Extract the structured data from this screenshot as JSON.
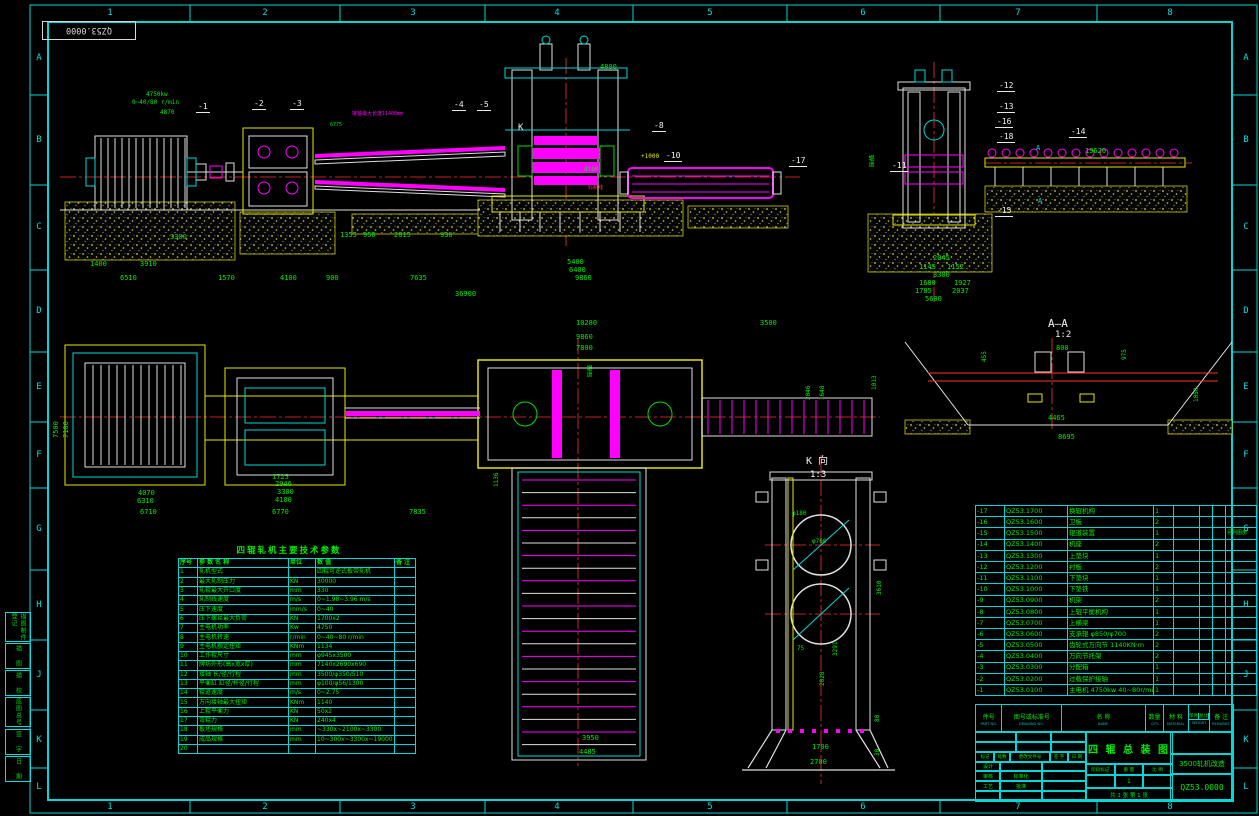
{
  "frame": {
    "corner_label": "QZ53.0000",
    "column_labels": [
      "1",
      "2",
      "3",
      "4",
      "5",
      "6",
      "7",
      "8"
    ],
    "row_labels": [
      "A",
      "B",
      "C",
      "D",
      "E",
      "F",
      "G",
      "H",
      "J",
      "K",
      "L"
    ]
  },
  "margin_notes": [
    "描图制件登记",
    "描 图",
    "描 校",
    "底图总号",
    "签 字",
    "日 期"
  ],
  "callouts": [
    {
      "t": "-1",
      "x": 196,
      "y": 103
    },
    {
      "t": "-2",
      "x": 252,
      "y": 100
    },
    {
      "t": "-3",
      "x": 290,
      "y": 100
    },
    {
      "t": "-4",
      "x": 452,
      "y": 101
    },
    {
      "t": "-5",
      "x": 477,
      "y": 101
    },
    {
      "t": "-8",
      "x": 652,
      "y": 122
    },
    {
      "t": "-10",
      "x": 664,
      "y": 152
    },
    {
      "t": "-17",
      "x": 789,
      "y": 157
    },
    {
      "t": "-12",
      "x": 997,
      "y": 82
    },
    {
      "t": "-13",
      "x": 997,
      "y": 103
    },
    {
      "t": "-16",
      "x": 995,
      "y": 118
    },
    {
      "t": "-18",
      "x": 997,
      "y": 133
    },
    {
      "t": "-14",
      "x": 1069,
      "y": 128
    },
    {
      "t": "-11",
      "x": 890,
      "y": 162
    },
    {
      "t": "-15",
      "x": 995,
      "y": 207
    }
  ],
  "labels": [
    {
      "t": "4800",
      "x": 600,
      "y": 64
    },
    {
      "t": "19620",
      "x": 1085,
      "y": 148
    },
    {
      "t": "3300",
      "x": 170,
      "y": 234
    },
    {
      "t": "1355",
      "x": 340,
      "y": 232
    },
    {
      "t": "950",
      "x": 363,
      "y": 232
    },
    {
      "t": "2815",
      "x": 394,
      "y": 232
    },
    {
      "t": "930",
      "x": 440,
      "y": 232
    },
    {
      "t": "1400",
      "x": 90,
      "y": 261
    },
    {
      "t": "3910",
      "x": 140,
      "y": 261
    },
    {
      "t": "6510",
      "x": 120,
      "y": 275
    },
    {
      "t": "1570",
      "x": 218,
      "y": 275
    },
    {
      "t": "4100",
      "x": 280,
      "y": 275
    },
    {
      "t": "900",
      "x": 326,
      "y": 275
    },
    {
      "t": "7635",
      "x": 410,
      "y": 275
    },
    {
      "t": "36900",
      "x": 455,
      "y": 291
    },
    {
      "t": "5400",
      "x": 567,
      "y": 259
    },
    {
      "t": "6400",
      "x": 569,
      "y": 267
    },
    {
      "t": "9860",
      "x": 575,
      "y": 275
    },
    {
      "t": "2045",
      "x": 933,
      "y": 255
    },
    {
      "t": "1145",
      "x": 919,
      "y": 264
    },
    {
      "t": "1152",
      "x": 947,
      "y": 264
    },
    {
      "t": "3300",
      "x": 933,
      "y": 272
    },
    {
      "t": "1680",
      "x": 919,
      "y": 280
    },
    {
      "t": "1927",
      "x": 954,
      "y": 280
    },
    {
      "t": "1785",
      "x": 915,
      "y": 288
    },
    {
      "t": "2037",
      "x": 952,
      "y": 288
    },
    {
      "t": "5600",
      "x": 925,
      "y": 296
    },
    {
      "t": "4870",
      "x": 160,
      "y": 110,
      "s": 6
    },
    {
      "t": "4750kw",
      "x": 146,
      "y": 92,
      "s": 6
    },
    {
      "t": "0~40/80 r/min",
      "x": 132,
      "y": 100,
      "s": 6
    },
    {
      "t": "接轴最大长度11400mm",
      "x": 352,
      "y": 112,
      "c": "m",
      "s": 5
    },
    {
      "t": "6775",
      "x": 330,
      "y": 123,
      "s": 5
    },
    {
      "t": "+1000",
      "x": 641,
      "y": 154,
      "c": "y",
      "s": 6
    },
    {
      "t": "4100",
      "x": 584,
      "y": 167,
      "s": 6
    },
    {
      "t": "轧制线",
      "x": 588,
      "y": 186,
      "c": "r",
      "s": 5
    },
    {
      "t": "K",
      "x": 518,
      "y": 124,
      "c": "w",
      "s": 9
    },
    {
      "t": "辊道",
      "x": 867,
      "y": 155,
      "s": 6,
      "r": "v"
    },
    {
      "t": "A",
      "x": 1036,
      "y": 145,
      "c": "c",
      "s": 7
    },
    {
      "t": "A",
      "x": 1038,
      "y": 198,
      "c": "c",
      "s": 7
    },
    {
      "t": "10280",
      "x": 576,
      "y": 320
    },
    {
      "t": "9860",
      "x": 576,
      "y": 334
    },
    {
      "t": "7800",
      "x": 576,
      "y": 345
    },
    {
      "t": "3500",
      "x": 760,
      "y": 320
    },
    {
      "t": "1013",
      "x": 872,
      "y": 390,
      "r": 90,
      "s": 6
    },
    {
      "t": "2046",
      "x": 806,
      "y": 400,
      "r": 90,
      "s": 6
    },
    {
      "t": "1648",
      "x": 820,
      "y": 400,
      "r": 90,
      "s": 6
    },
    {
      "t": "7500",
      "x": 53,
      "y": 438,
      "r": 90
    },
    {
      "t": "7100",
      "x": 63,
      "y": 438,
      "r": 90
    },
    {
      "t": "1725",
      "x": 272,
      "y": 474
    },
    {
      "t": "2946",
      "x": 275,
      "y": 481
    },
    {
      "t": "3300",
      "x": 277,
      "y": 489
    },
    {
      "t": "4100",
      "x": 275,
      "y": 497
    },
    {
      "t": "4070",
      "x": 138,
      "y": 490
    },
    {
      "t": "6310",
      "x": 137,
      "y": 498
    },
    {
      "t": "6710",
      "x": 140,
      "y": 509
    },
    {
      "t": "6770",
      "x": 272,
      "y": 509
    },
    {
      "t": "7835",
      "x": 409,
      "y": 509
    },
    {
      "t": "1136",
      "x": 494,
      "y": 487,
      "r": 90,
      "s": 6
    },
    {
      "t": "辊道",
      "x": 585,
      "y": 365,
      "s": 6,
      "r": "v"
    },
    {
      "t": "3950",
      "x": 582,
      "y": 735
    },
    {
      "t": "4485",
      "x": 579,
      "y": 749
    },
    {
      "t": "A—A",
      "x": 1048,
      "y": 318,
      "c": "w",
      "s": 11
    },
    {
      "t": "1:2",
      "x": 1055,
      "y": 331,
      "c": "w",
      "s": 9
    },
    {
      "t": "800",
      "x": 1056,
      "y": 345
    },
    {
      "t": "455",
      "x": 982,
      "y": 362,
      "r": 90,
      "s": 6
    },
    {
      "t": "975",
      "x": 1122,
      "y": 360,
      "r": 90,
      "s": 6
    },
    {
      "t": "1050",
      "x": 1194,
      "y": 402,
      "r": 90,
      "s": 6
    },
    {
      "t": "4465",
      "x": 1048,
      "y": 415
    },
    {
      "t": "8695",
      "x": 1058,
      "y": 434
    },
    {
      "t": "K 向",
      "x": 806,
      "y": 457,
      "c": "w",
      "s": 10
    },
    {
      "t": "1:3",
      "x": 810,
      "y": 471,
      "c": "w",
      "s": 9
    },
    {
      "t": "φ180",
      "x": 792,
      "y": 511,
      "s": 6
    },
    {
      "t": "φ760",
      "x": 812,
      "y": 539,
      "s": 6
    },
    {
      "t": "3610",
      "x": 877,
      "y": 595,
      "r": 90,
      "s": 6
    },
    {
      "t": "75",
      "x": 797,
      "y": 646,
      "s": 6
    },
    {
      "t": "3291",
      "x": 833,
      "y": 656,
      "r": 90,
      "s": 6
    },
    {
      "t": "2028",
      "x": 820,
      "y": 686,
      "r": 90,
      "s": 6
    },
    {
      "t": "80",
      "x": 875,
      "y": 722,
      "r": 90,
      "s": 6
    },
    {
      "t": "30",
      "x": 875,
      "y": 756,
      "r": 90,
      "s": 6
    },
    {
      "t": "1700",
      "x": 812,
      "y": 744
    },
    {
      "t": "2700",
      "x": 810,
      "y": 759
    }
  ],
  "spec_table": {
    "title": "四辊轧机主要技术参数",
    "headers": [
      "序号",
      "参 数 名 称",
      "单位",
      "数    值",
      "备 注"
    ],
    "rows": [
      [
        "1",
        "轧机型式",
        "",
        "四辊可逆式板带轧机",
        ""
      ],
      [
        "2",
        "最大轧制压力",
        "KN",
        "30000",
        ""
      ],
      [
        "3",
        "轧辊最大开口度",
        "mm",
        "330",
        ""
      ],
      [
        "4",
        "轧制线速度",
        "m/s",
        "0~1.98~3.96 m/s",
        ""
      ],
      [
        "5",
        "压下速度",
        "mm/s",
        "0~40",
        ""
      ],
      [
        "6",
        "压下螺丝最大负荷",
        "KN",
        "1700x2",
        ""
      ],
      [
        "7",
        "主电机功率",
        "Kw",
        "4750",
        ""
      ],
      [
        "8",
        "主电机转速",
        "r/min",
        "0~40~80 r/min",
        ""
      ],
      [
        "9",
        "主电机额定扭矩",
        "KNm",
        "1134",
        ""
      ],
      [
        "10",
        "工作辊尺寸",
        "mm",
        "φ945x3500",
        ""
      ],
      [
        "11",
        "牌坊外形(高x宽x厚)",
        "mm",
        "7140x2690x690",
        ""
      ],
      [
        "12",
        "接轴 长/径/行程",
        "mm",
        "3500/φ350/510",
        ""
      ],
      [
        "13",
        "平衡缸 缸径/杆径/行程",
        "mm",
        "φ100/φ56/1300",
        ""
      ],
      [
        "14",
        "辊道速度",
        "m/s",
        "0~2.75",
        ""
      ],
      [
        "15",
        "万向接轴最大扭矩",
        "KNm",
        "1140",
        ""
      ],
      [
        "16",
        "上辊平衡力",
        "KN",
        "50x2",
        ""
      ],
      [
        "17",
        "弯辊力",
        "KN",
        "240x4",
        ""
      ],
      [
        "18",
        "板坯规格",
        "mm",
        "~330x~2100x~3300",
        ""
      ],
      [
        "19",
        "成品规格",
        "mm",
        "10~300x~3300x~19000",
        ""
      ],
      [
        "20",
        "",
        "",
        "",
        ""
      ]
    ]
  },
  "bom": {
    "headers": {
      "part_no": "件号",
      "part_no_en": "PART NO.",
      "dwg_no": "图号或标准号",
      "dwg_no_en": "DRAWING NO.",
      "name": "名  称",
      "name_en": "NAME",
      "qty": "数量",
      "qty_en": "QTY.",
      "material": "材 料",
      "material_en": "MATERIAL",
      "weight_single": "单件",
      "weight_total": "总计",
      "weight": "重 量",
      "weight_en": "WEIGHT",
      "remark": "备 注",
      "remark_en": "REMARKS"
    },
    "rows": [
      [
        "-17",
        "QZ53.1700",
        "换辊机构",
        "1",
        ""
      ],
      [
        "-16",
        "QZ53.1600",
        "卫板",
        "2",
        ""
      ],
      [
        "-15",
        "QZ53.1500",
        "辊道装置",
        "1",
        "另列图册"
      ],
      [
        "-14",
        "QZ53.1400",
        "机座",
        "2",
        ""
      ],
      [
        "-13",
        "QZ53.1300",
        "上垫块",
        "1",
        ""
      ],
      [
        "-12",
        "QZ53.1200",
        "衬板",
        "2",
        ""
      ],
      [
        "-11",
        "QZ53.1100",
        "下垫块",
        "1",
        ""
      ],
      [
        "-10",
        "QZ53.1000",
        "下垫铁",
        "1",
        ""
      ],
      [
        "-9",
        "QZ53.0900",
        "机架",
        "2",
        ""
      ],
      [
        "-8",
        "QZ53.0800",
        "上辊平衡机构",
        "1",
        ""
      ],
      [
        "-7",
        "QZ53.0700",
        "上横梁",
        "1",
        ""
      ],
      [
        "-6",
        "QZ53.0600",
        "支承辊  φ850/φ700",
        "2",
        ""
      ],
      [
        "-5",
        "QZ53.0500",
        "齿轮式万向节  1140KN·m",
        "2",
        ""
      ],
      [
        "-4",
        "QZ53.0400",
        "万向节托架",
        "2",
        ""
      ],
      [
        "-3",
        "QZ53.0300",
        "分配箱",
        "1",
        ""
      ],
      [
        "-2",
        "QZ53.0200",
        "过载保护接轴",
        "1",
        ""
      ],
      [
        "-1",
        "QZ53.0100",
        "主电机 4750kw 40~80r/min",
        "1",
        ""
      ]
    ]
  },
  "title_block": {
    "title": "四 辊 总 装 图",
    "project": "3500轧机改造",
    "drawing_no": "QZ53.0000",
    "rev_headers": [
      "标记",
      "处数",
      "更改文件号",
      "签 字",
      "日 期"
    ],
    "roles": {
      "design": "设计",
      "check": "审核",
      "process": "工艺",
      "standard": "标准化",
      "approve": "批准"
    },
    "stage_headers": [
      "阶段标记",
      "重 量",
      "比 例"
    ],
    "stage_value": "1",
    "sheet_info": "共 1 张  第 1 张"
  }
}
